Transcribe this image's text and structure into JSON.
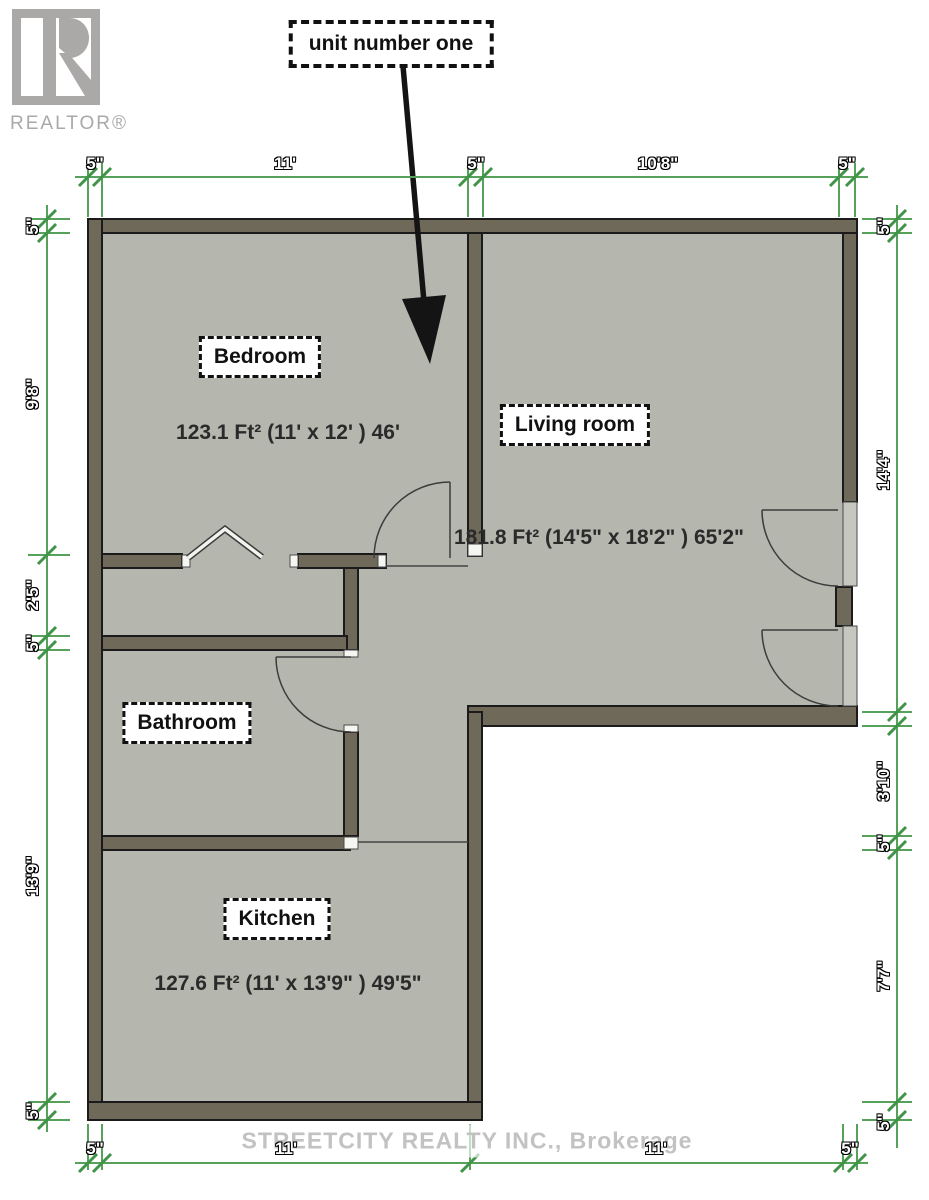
{
  "branding": {
    "realtor_wordmark": "REALTOR®"
  },
  "callout": {
    "text": "unit number one"
  },
  "rooms": {
    "bedroom": {
      "label": "Bedroom",
      "area": "123.1 Ft² (11'  x 12' ) 46'"
    },
    "living": {
      "label": "Living room",
      "area": "181.8 Ft² (14'5\"  x 18'2\" ) 65'2\""
    },
    "bathroom": {
      "label": "Bathroom"
    },
    "kitchen": {
      "label": "Kitchen",
      "area": "127.6 Ft² (11'  x 13'9\" ) 49'5\""
    }
  },
  "watermark": {
    "text": "STREETCITY REALTY INC., Brokerage"
  },
  "dimensions": {
    "top": [
      {
        "label": "5\"",
        "x": 95
      },
      {
        "label": "11'",
        "x": 285
      },
      {
        "label": "5\"",
        "x": 476
      },
      {
        "label": "10'8\"",
        "x": 658
      },
      {
        "label": "5\"",
        "x": 847
      }
    ],
    "bottom": [
      {
        "label": "5\"",
        "x": 95
      },
      {
        "label": "11'",
        "x": 286
      },
      {
        "label": "11'",
        "x": 656
      },
      {
        "label": "5\"",
        "x": 850
      }
    ],
    "left": [
      {
        "label": "5\"",
        "y": 226
      },
      {
        "label": "9'8\"",
        "y": 394
      },
      {
        "label": "2'5\"",
        "y": 595
      },
      {
        "label": "5\"",
        "y": 643
      },
      {
        "label": "13'9\"",
        "y": 876
      },
      {
        "label": "5\"",
        "y": 1111
      }
    ],
    "right": [
      {
        "label": "5\"",
        "y": 226
      },
      {
        "label": "14'4\"",
        "y": 470
      },
      {
        "label": "3'10\"",
        "y": 781
      },
      {
        "label": "5\"",
        "y": 843
      },
      {
        "label": "7'7\"",
        "y": 976
      },
      {
        "label": "5\"",
        "y": 1122
      }
    ]
  },
  "colors": {
    "wall": "#6e6959",
    "floor": "#b5b6ae",
    "dimension_line_green": "#57a25b",
    "tick_green": "#3f9447",
    "room_label_ink": "#111111",
    "watermark_gray": "#c2c2c2",
    "logo_gray": "#aba8a8"
  }
}
